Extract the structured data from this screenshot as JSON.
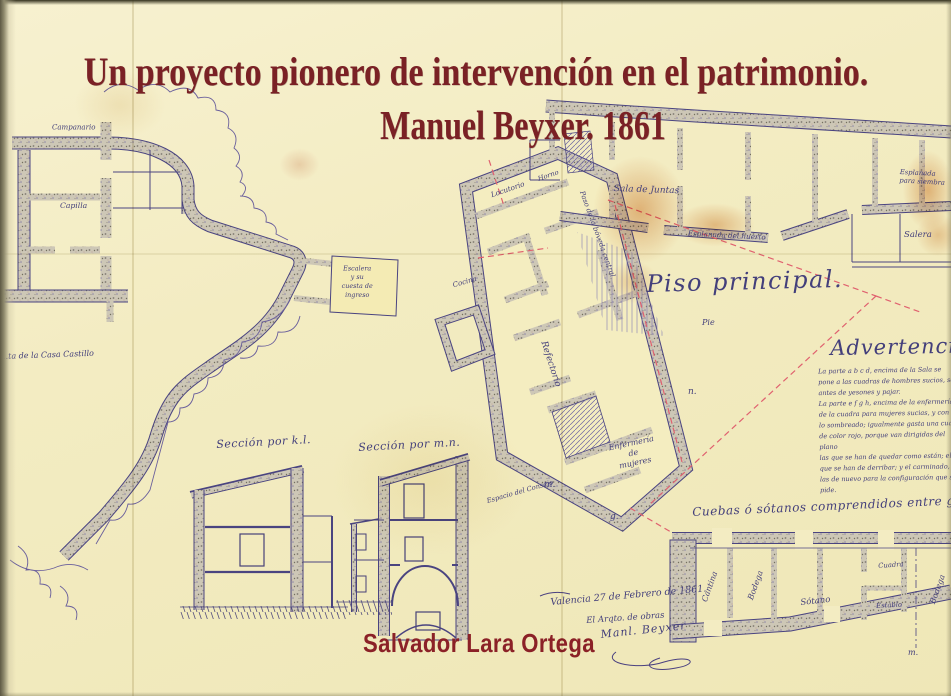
{
  "cover": {
    "title_line1": "Un proyecto pionero de intervención en el patrimonio.",
    "title_line2": "Manuel Beyxer. 1861",
    "author": "Salvador Lara Ortega"
  },
  "plan": {
    "piso_principal": "Piso principal.",
    "piso_sub": "Pie",
    "casa_castillo": "…ta de la Casa Castillo",
    "campanario": "Campanario",
    "capilla": "Capilla",
    "tower_line1": "Escalera",
    "tower_line2": "y su",
    "tower_line3": "cuesta de ingreso",
    "locutorio": "Locutorio",
    "horno": "Horno",
    "cocina": "Cocina",
    "paso_boveda": "Paso de la bóveda central",
    "refectorio": "Refectorio",
    "enfermeria_1": "Enfermería",
    "enfermeria_2": "de",
    "enfermeria_3": "mujeres",
    "espacio": "Espacio del Consejo",
    "letter_m": "m.",
    "letter_n": "n.",
    "letter_g": "g.",
    "sala_juntas": "Sala de Juntas",
    "esplanada_1": "Esplanada del huerto",
    "esplanada_2": "Esplanada para siembra",
    "salera": "Salera"
  },
  "advertencias": {
    "title": "Advertencias",
    "lines": [
      "La parte a b c d, encima de la Sala se",
      "pone a las cuadras de hombres sucios, se",
      "antes de yesones y pajar.",
      "La parte e f g h, encima de la enfermería",
      "de la cuadra para mujeres sucias, y con",
      "lo sombreado; igualmente gasta una cuarta",
      "de color rojo, porque van dirigidas del plano",
      "las que se han de quedar como están; el",
      "que se han de derribar; y el carminado,",
      "las de nuevo para la configuración que se pide."
    ]
  },
  "sections": {
    "kl": "Sección por k.l.",
    "mn": "Sección por m.n."
  },
  "cellars": {
    "caption": "Cuebas ó sótanos comprendidos entre g. h. i. j.",
    "room_1": "Cantina",
    "room_2": "Bodega",
    "room_3": "Sótano",
    "room_4": "Cuadra",
    "room_5": "Establo",
    "room_6": "Bodega",
    "axis_letter": "m."
  },
  "colophon": {
    "line1": "Valencia 27 de Febrero de 1861.",
    "line2": "El Arqto. de obras",
    "signature": "Manl. Beyxer"
  }
}
